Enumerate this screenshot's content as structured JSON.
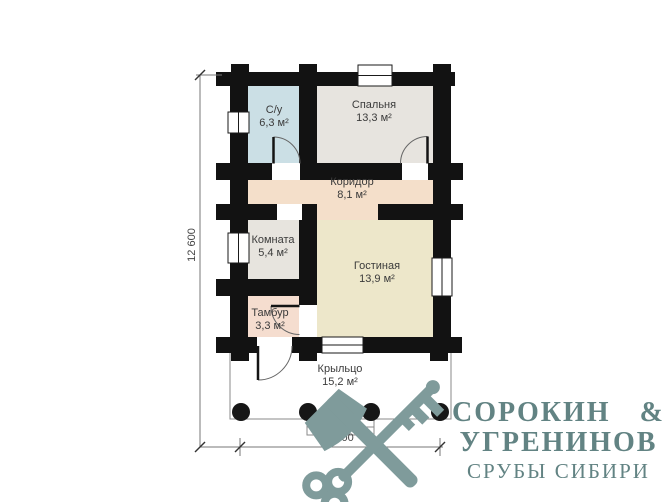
{
  "plan": {
    "rooms": {
      "su": {
        "name": "С/у",
        "area": "6,3 м²",
        "color": "#cbdfe5"
      },
      "bedroom": {
        "name": "Спальня",
        "area": "13,3 м²",
        "color": "#e7e4df"
      },
      "corridor": {
        "name": "Коридор",
        "area": "8,1 м²",
        "color": "#f4dfca"
      },
      "room": {
        "name": "Комната",
        "area": "5,4 м²",
        "color": "#e7e4de"
      },
      "living": {
        "name": "Гостиная",
        "area": "13,9 м²",
        "color": "#ede7ca"
      },
      "tambour": {
        "name": "Тамбур",
        "area": "3,3 м²",
        "color": "#f5ddcf"
      },
      "porch": {
        "name": "Крыльцо",
        "area": "15,2 м²",
        "color": "#ffffff"
      }
    },
    "dimensions": {
      "height_label": "12 600",
      "width_label": "7 600"
    },
    "wall_color": "#121212"
  },
  "logo": {
    "line1": "СОРОКИН &",
    "line2": "УГРЕНИНОВ",
    "line3": "СРУБЫ СИБИРИ",
    "text_color": "#628383",
    "icon_color": "#7f9b9b",
    "icon": "crossed-axe-and-key"
  }
}
